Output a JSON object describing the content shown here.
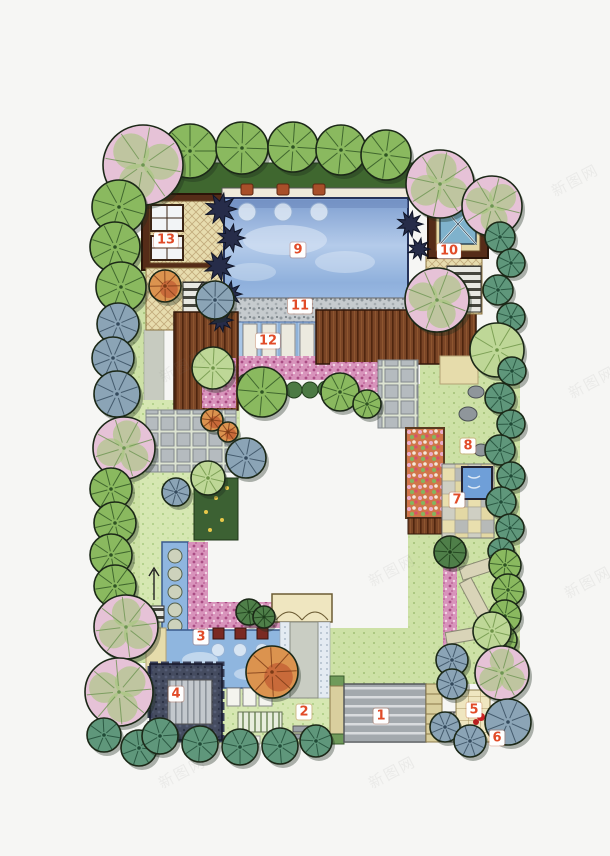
{
  "page": {
    "background": "#f6f6f4"
  },
  "watermark": {
    "text": "新图网",
    "positions": [
      {
        "x": 183,
        "y": 366
      },
      {
        "x": 392,
        "y": 570
      },
      {
        "x": 575,
        "y": 180
      },
      {
        "x": 592,
        "y": 382
      },
      {
        "x": 588,
        "y": 582
      },
      {
        "x": 392,
        "y": 772
      },
      {
        "x": 182,
        "y": 772
      }
    ]
  },
  "plan": {
    "label_style": {
      "text_color": "#e14b28",
      "bg": "#ffffff"
    },
    "labels": [
      {
        "n": "1",
        "x": 381,
        "y": 716
      },
      {
        "n": "2",
        "x": 304,
        "y": 712
      },
      {
        "n": "3",
        "x": 201,
        "y": 637
      },
      {
        "n": "4",
        "x": 176,
        "y": 694
      },
      {
        "n": "5",
        "x": 474,
        "y": 710
      },
      {
        "n": "6",
        "x": 497,
        "y": 738
      },
      {
        "n": "7",
        "x": 457,
        "y": 500
      },
      {
        "n": "8",
        "x": 468,
        "y": 446
      },
      {
        "n": "9",
        "x": 298,
        "y": 250
      },
      {
        "n": "10",
        "x": 449,
        "y": 251
      },
      {
        "n": "11",
        "x": 300,
        "y": 306
      },
      {
        "n": "12",
        "x": 268,
        "y": 341
      },
      {
        "n": "13",
        "x": 166,
        "y": 240
      }
    ],
    "palette": {
      "g": {
        "fill": "#8ab95f",
        "line": "#2e5323"
      },
      "lt": {
        "fill": "#bed797",
        "line": "#6e9447"
      },
      "bg": {
        "fill": "#8ba4b6",
        "line": "#33495c"
      },
      "teal": {
        "fill": "#5f977b",
        "line": "#1f4a36"
      },
      "pk": {
        "fill": "#e6c2d7",
        "line": "#6d9552"
      },
      "or": {
        "fill": "#db934f",
        "line": "#7a3a16"
      },
      "dg": {
        "fill": "#4f7f49",
        "line": "#1d3d1a"
      }
    },
    "trees": [
      [
        "g",
        190,
        151,
        27
      ],
      [
        "g",
        242,
        148,
        26
      ],
      [
        "g",
        293,
        147,
        25
      ],
      [
        "g",
        341,
        150,
        25
      ],
      [
        "g",
        386,
        155,
        25
      ],
      [
        "pk",
        143,
        165,
        40
      ],
      [
        "pk",
        440,
        184,
        34
      ],
      [
        "pk",
        492,
        206,
        30
      ],
      [
        "g",
        119,
        207,
        27
      ],
      [
        "g",
        115,
        247,
        25
      ],
      [
        "g",
        121,
        287,
        25
      ],
      [
        "bg",
        118,
        324,
        21
      ],
      [
        "bg",
        113,
        358,
        21
      ],
      [
        "bg",
        117,
        394,
        23
      ],
      [
        "pk",
        124,
        448,
        31
      ],
      [
        "g",
        111,
        489,
        21
      ],
      [
        "g",
        115,
        523,
        21
      ],
      [
        "g",
        111,
        555,
        21
      ],
      [
        "g",
        115,
        586,
        21
      ],
      [
        "pk",
        126,
        627,
        32
      ],
      [
        "pk",
        119,
        692,
        34
      ],
      [
        "teal",
        104,
        735,
        17
      ],
      [
        "teal",
        139,
        748,
        18
      ],
      [
        "bg",
        215,
        300,
        19
      ],
      [
        "lt",
        213,
        368,
        21
      ],
      [
        "g",
        262,
        392,
        25
      ],
      [
        "or",
        212,
        420,
        11
      ],
      [
        "or",
        228,
        432,
        10
      ],
      [
        "bg",
        246,
        458,
        20
      ],
      [
        "lt",
        208,
        478,
        17
      ],
      [
        "bg",
        176,
        492,
        14
      ],
      [
        "g",
        340,
        392,
        19
      ],
      [
        "g",
        367,
        404,
        14
      ],
      [
        "pk",
        437,
        300,
        32
      ],
      [
        "teal",
        500,
        237,
        15
      ],
      [
        "teal",
        511,
        263,
        14
      ],
      [
        "teal",
        498,
        290,
        15
      ],
      [
        "teal",
        511,
        317,
        14
      ],
      [
        "lt",
        497,
        350,
        27
      ],
      [
        "teal",
        512,
        371,
        14
      ],
      [
        "teal",
        500,
        398,
        15
      ],
      [
        "teal",
        511,
        424,
        14
      ],
      [
        "teal",
        500,
        450,
        15
      ],
      [
        "teal",
        511,
        476,
        14
      ],
      [
        "teal",
        501,
        502,
        15
      ],
      [
        "teal",
        510,
        528,
        14
      ],
      [
        "teal",
        501,
        551,
        13
      ],
      [
        "dg",
        450,
        552,
        16
      ],
      [
        "g",
        505,
        565,
        16
      ],
      [
        "g",
        508,
        590,
        16
      ],
      [
        "g",
        505,
        616,
        16
      ],
      [
        "g",
        503,
        640,
        14
      ],
      [
        "lt",
        492,
        631,
        19
      ],
      [
        "pk",
        502,
        673,
        27
      ],
      [
        "bg",
        452,
        660,
        16
      ],
      [
        "bg",
        452,
        684,
        15
      ],
      [
        "bg",
        445,
        727,
        15
      ],
      [
        "bg",
        508,
        722,
        23
      ],
      [
        "bg",
        470,
        741,
        16
      ],
      [
        "teal",
        160,
        736,
        18
      ],
      [
        "teal",
        200,
        744,
        18
      ],
      [
        "teal",
        240,
        747,
        18
      ],
      [
        "teal",
        280,
        746,
        18
      ],
      [
        "teal",
        316,
        741,
        16
      ],
      [
        "dg",
        249,
        612,
        13
      ],
      [
        "dg",
        264,
        617,
        11
      ],
      [
        "or",
        272,
        672,
        26
      ],
      [
        "or",
        165,
        286,
        16
      ]
    ],
    "navy_plants": [
      [
        221,
        209,
        16
      ],
      [
        231,
        238,
        14
      ],
      [
        219,
        266,
        15
      ],
      [
        229,
        294,
        13
      ],
      [
        221,
        320,
        12
      ],
      [
        410,
        224,
        13
      ],
      [
        419,
        249,
        11
      ]
    ]
  }
}
